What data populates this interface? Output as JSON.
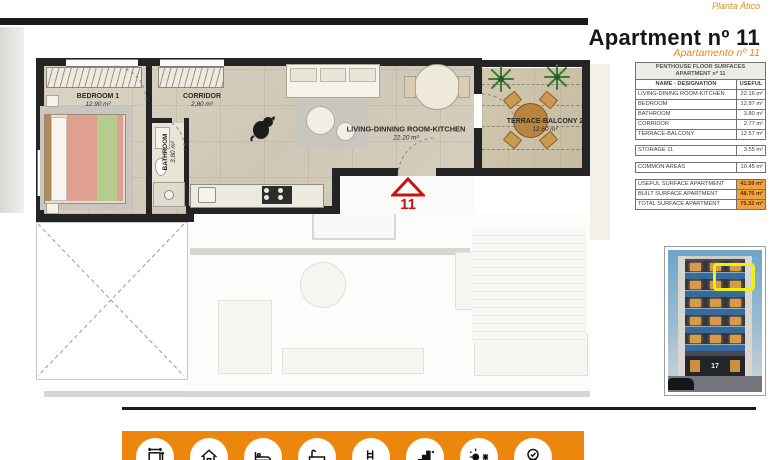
{
  "header": {
    "plan_level": "Planta Ático",
    "title": "Apartment nº 11",
    "subtitle": "Apartamento nº 11"
  },
  "floor_plan": {
    "entrance_number": "11",
    "rooms": [
      {
        "name": "BEDROOM 1",
        "area": "12.90 m²"
      },
      {
        "name": "CORRIDOR",
        "area": "2,80 m²"
      },
      {
        "name": "BATHROOM",
        "area": "3,80 m²"
      },
      {
        "name": "LIVING-DINNING ROOM-KITCHEN",
        "area": "22.20 m²"
      },
      {
        "name": "TERRACE-BALCONY 2",
        "area": "12,60 m²"
      }
    ]
  },
  "surfaces_table": {
    "title_line1": "PENTHOUSE FLOOR SURFACES",
    "title_line2": "APARTMENT nº 11",
    "columns": [
      "NAME - DESIGNATION",
      "USEFUL"
    ],
    "rows": [
      {
        "name": "LIVING-DINING ROOM-KITCHEN",
        "value": "22.16 m²"
      },
      {
        "name": "BEDROOM",
        "value": "12.87 m²"
      },
      {
        "name": "BATHROOM",
        "value": "3.80 m²"
      },
      {
        "name": "CORRIDOR",
        "value": "2.77 m²"
      },
      {
        "name": "TERRACE-BALCONY",
        "value": "12.57 m²"
      }
    ],
    "storage": {
      "name": "STORAGE 11",
      "value": "3.55 m²"
    },
    "common": {
      "name": "COMMON AREAS",
      "value": "10.45 m²"
    },
    "totals": [
      {
        "name": "USEFUL SURFACE APARTMENT",
        "value": "41.59 m²"
      },
      {
        "name": "BUILT SURFACE APARTMENT",
        "value": "48.75 m²"
      },
      {
        "name": "TOTAL SURFACE APARTMENT",
        "value": "75.32 m²"
      }
    ]
  },
  "building_photo": {
    "street_number": "17"
  },
  "footer": {
    "icons": [
      "dimensions-icon",
      "house-icon",
      "bed-icon",
      "bathtub-icon",
      "pool-icon",
      "energy-rating-icon",
      "climate-icon",
      "quality-badge-icon"
    ]
  },
  "colors": {
    "accent_orange": "#ec860d",
    "table_highlight": "#f1a33f",
    "marker_red": "#cc1111",
    "unit_highlight_yellow": "#f0ee18",
    "wall_black": "#242424"
  }
}
